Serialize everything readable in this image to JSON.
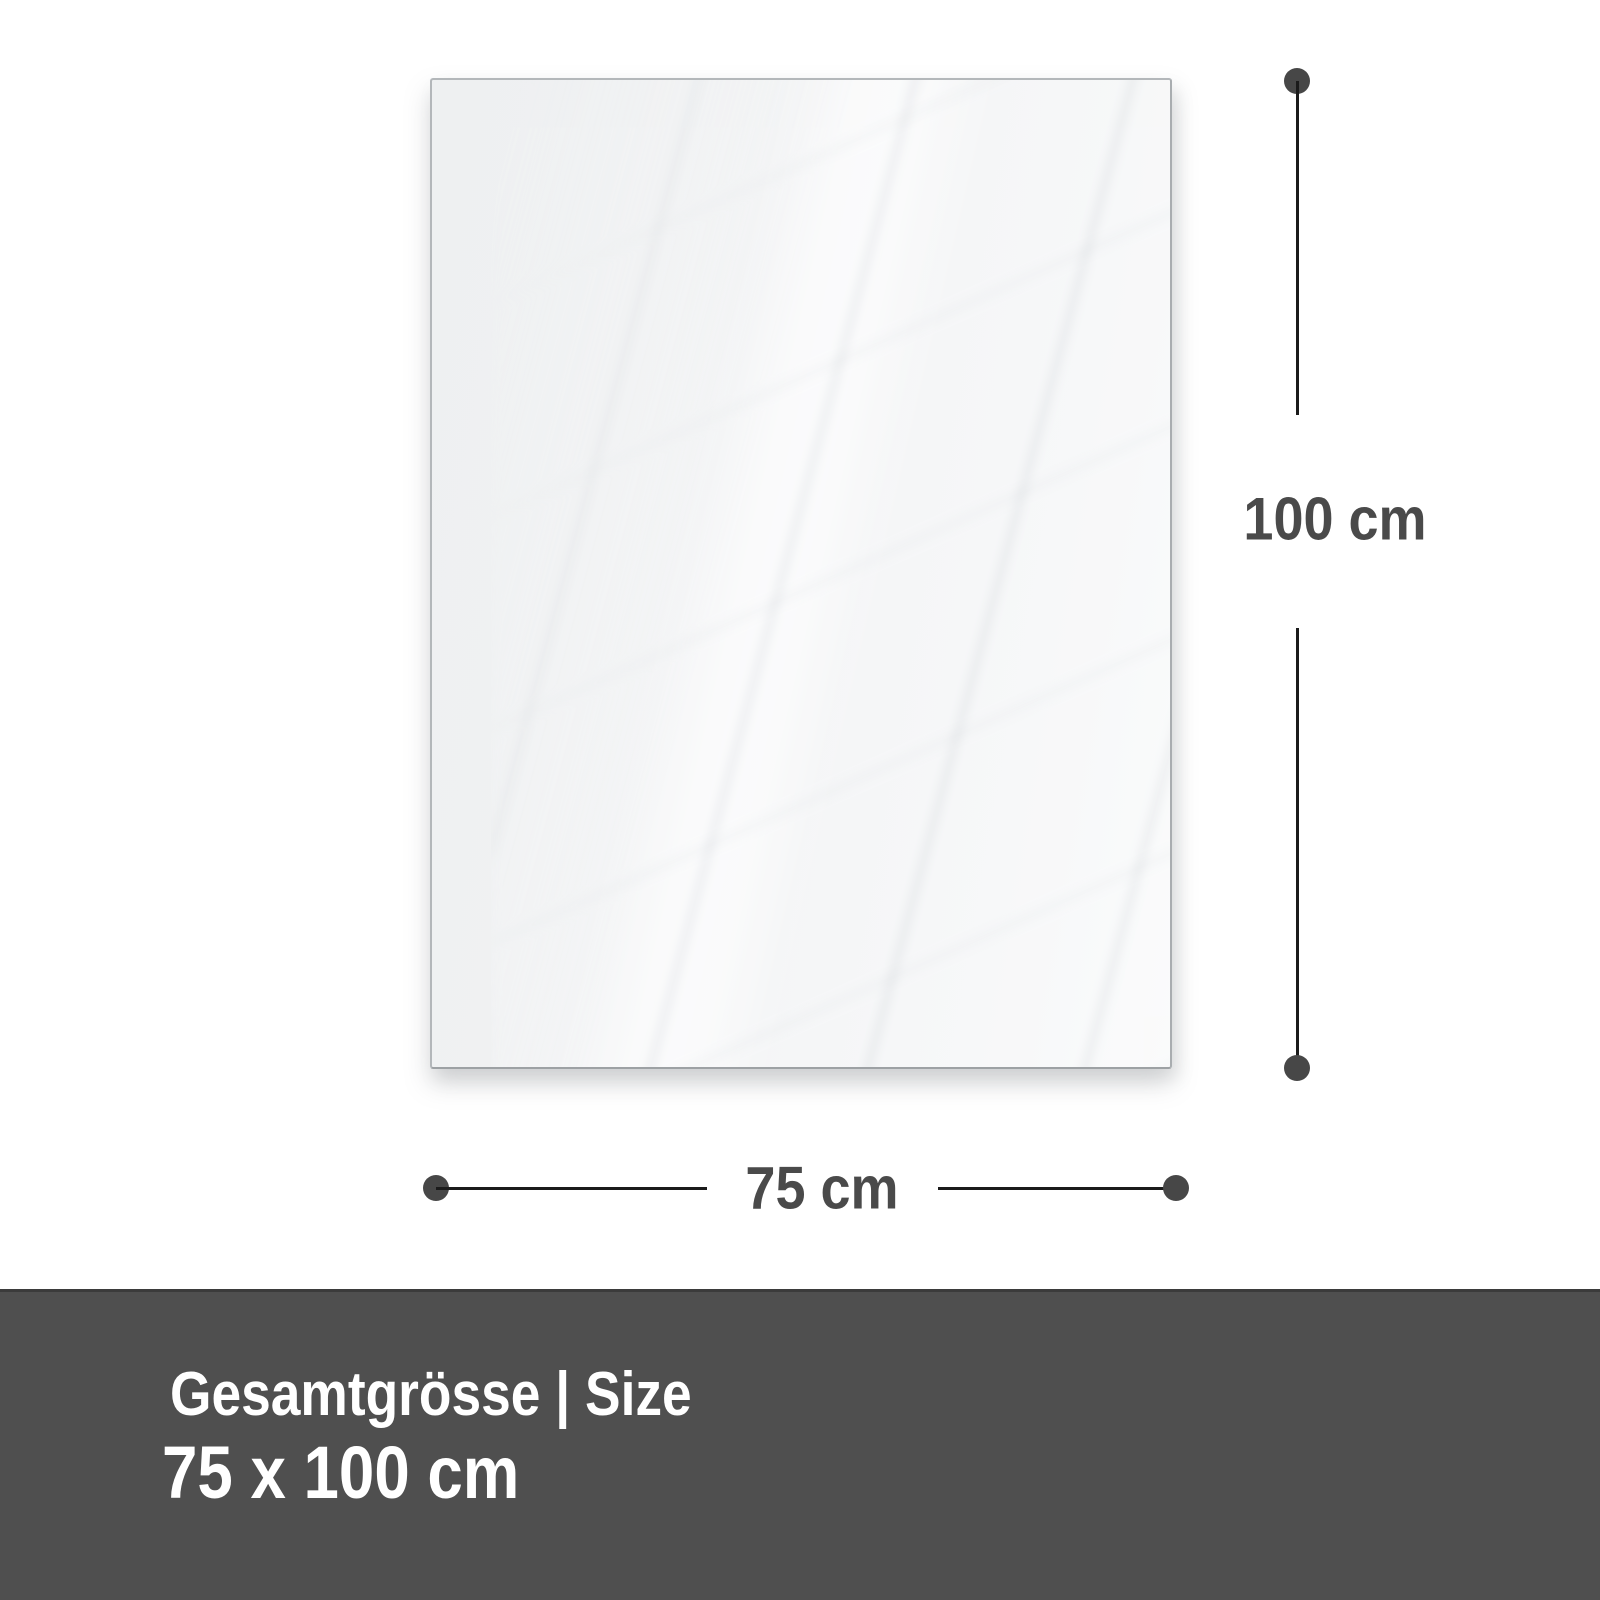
{
  "diagram": {
    "height_dimension": {
      "label": "100 cm"
    },
    "width_dimension": {
      "label": "75 cm"
    }
  },
  "footer": {
    "heading": "Gesamtgrösse | Size",
    "size_value": "75 x 100 cm"
  },
  "colors": {
    "background": "#ffffff",
    "panel_fill": "#f1f2f3",
    "panel_border": "#aeb2b5",
    "dimension_line": "#1b1b1b",
    "dimension_dot": "#474747",
    "dimension_text": "#4a4a4a",
    "footer_background": "#4f4f4f",
    "footer_border_top": "#3b3b3b",
    "footer_text": "#ffffff"
  }
}
